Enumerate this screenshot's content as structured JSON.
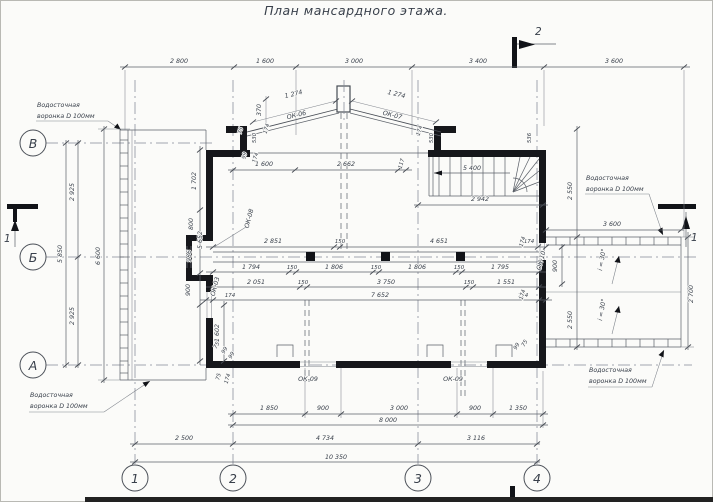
{
  "title": "План мансардного этажа.",
  "axis": {
    "h": [
      "В",
      "Б",
      "А"
    ],
    "v": [
      "1",
      "2",
      "3",
      "4"
    ]
  },
  "sections": {
    "left": "1",
    "right": "1",
    "top": "2",
    "bottom": "2"
  },
  "drains": {
    "line1": "Водосточная",
    "line2": "воронка D 100мм"
  },
  "slope_note": "i = 30°",
  "windows": {
    "ok06": "ОК-06",
    "ok07": "ОК-07",
    "ok08": "ОК-08",
    "ok03": "ОК-03",
    "ok09": "ОК-09",
    "ok10": "ОК-10"
  },
  "dims": {
    "top_chain": [
      "2 800",
      "1 600",
      "3 000",
      "3 400",
      "3 600"
    ],
    "bottom_openings": [
      "1 850",
      "900",
      "3 000",
      "900",
      "1 350"
    ],
    "bottom_total": "8 000",
    "bottom_spans": [
      "2 500",
      "4 734",
      "3 116"
    ],
    "bottom_overall": "10 350",
    "left": {
      "v2925a": "2 925",
      "v2925b": "2 925",
      "v5850": "5 850",
      "v6600": "6 600"
    },
    "left_wall": [
      "1 702",
      "800",
      "986",
      "900",
      "1 602"
    ],
    "roof": {
      "slope_left": "1 274",
      "slope_right": "1 274",
      "rise": "370",
      "l75": "75",
      "l530": "530",
      "l174": "174",
      "l99": "99",
      "l174b": "174",
      "r174": "174",
      "r530": "530",
      "r536": "536"
    },
    "mid1": [
      "5 652",
      "2 851",
      "150",
      "4 651",
      "174"
    ],
    "mid2": [
      "1 794",
      "150",
      "1 806",
      "150",
      "1 806",
      "150",
      "1 795"
    ],
    "mid3": [
      "2 051",
      "150",
      "3 750",
      "150",
      "1 551"
    ],
    "mid4": [
      "174",
      "7 652",
      "174"
    ],
    "upper": [
      "1 600",
      "2 662",
      "117"
    ],
    "stairs": {
      "mark": "5 400",
      "width": "2 942"
    },
    "right": {
      "t2550": "2 550",
      "t3600": "3 600",
      "v900": "900",
      "v2700": "2 700",
      "b2550": "2 550",
      "w174a": "174",
      "w174b": "174"
    },
    "corners": {
      "bl": [
        "75",
        "99",
        "99"
      ],
      "bl2": [
        "75",
        "174"
      ],
      "br": [
        "99",
        "75"
      ]
    }
  }
}
